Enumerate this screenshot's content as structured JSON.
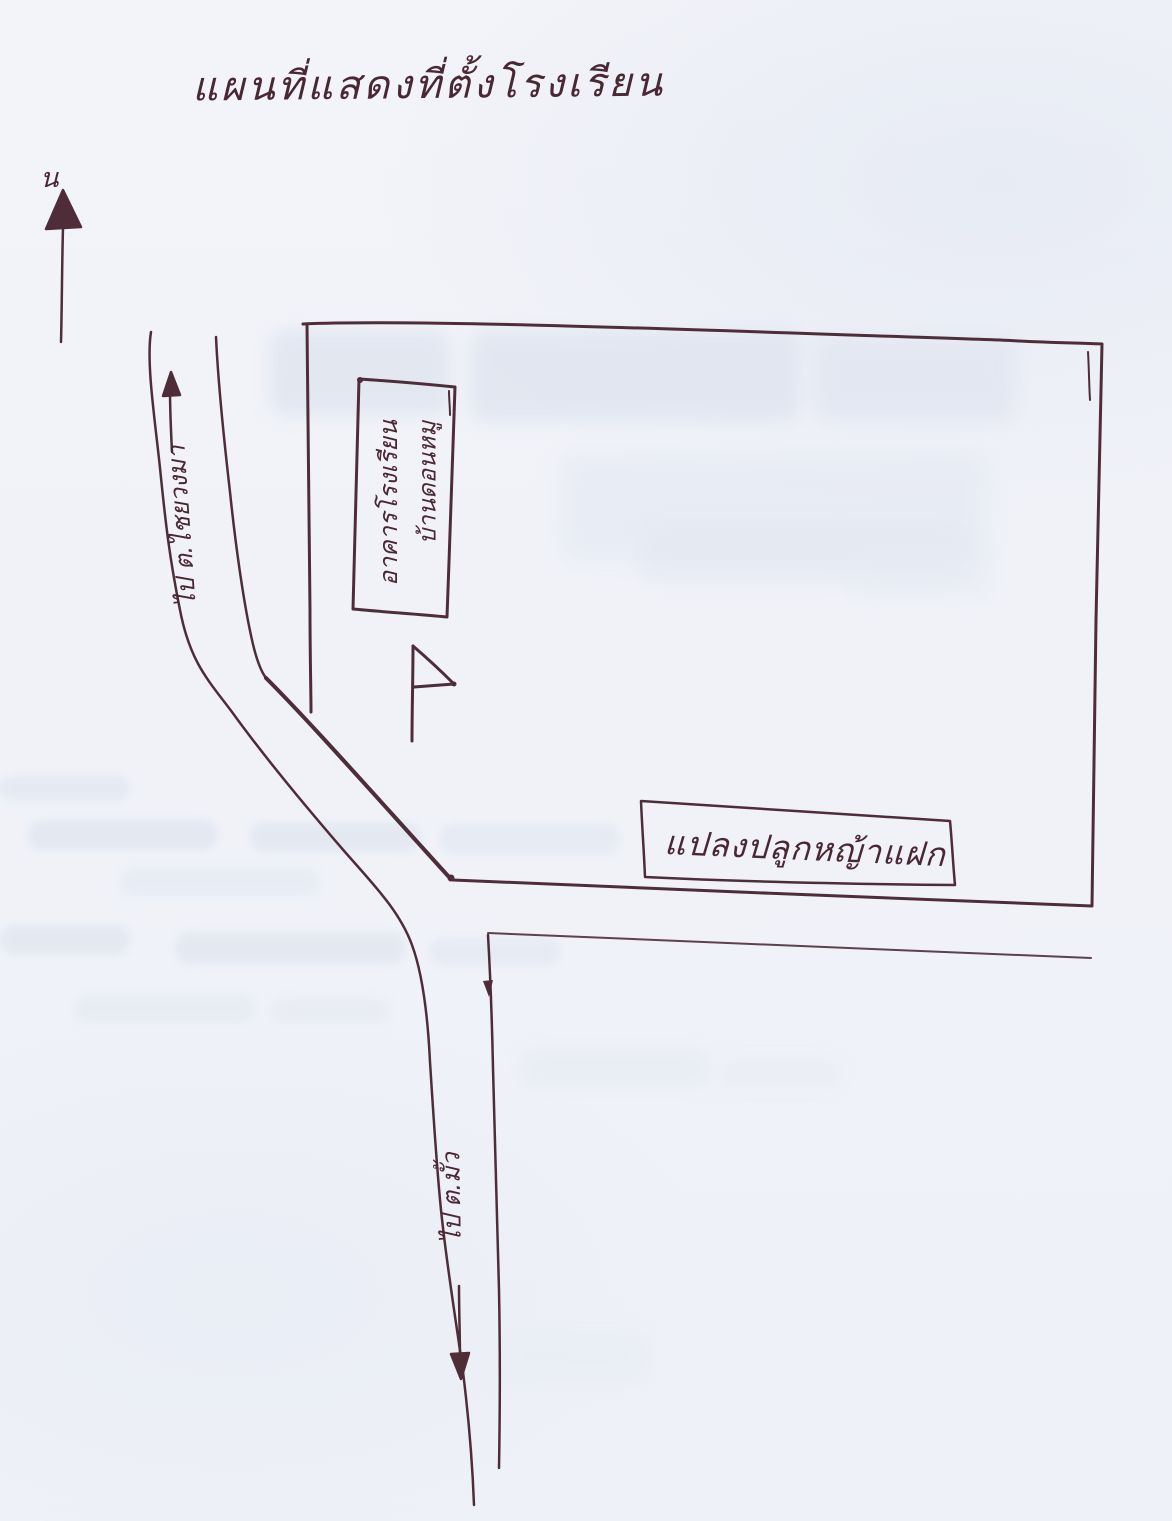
{
  "page": {
    "title": "แผนที่แสดงที่ตั้งโรงเรียน",
    "paper_color": "#f1f3f8",
    "ink_color": "#4a2833",
    "ghost_color": "#dee4ef"
  },
  "compass": {
    "north_label": "น"
  },
  "school": {
    "building_line1": "อาคารโรงเรียน",
    "building_line2": "บ้านดอนหมู",
    "grass_plot_label": "แปลงปลูกหญ้าแฝก"
  },
  "roads": {
    "west_label": "ไป ต.ไชยวงมา",
    "south_label": "ไป ต.มั้ว"
  }
}
